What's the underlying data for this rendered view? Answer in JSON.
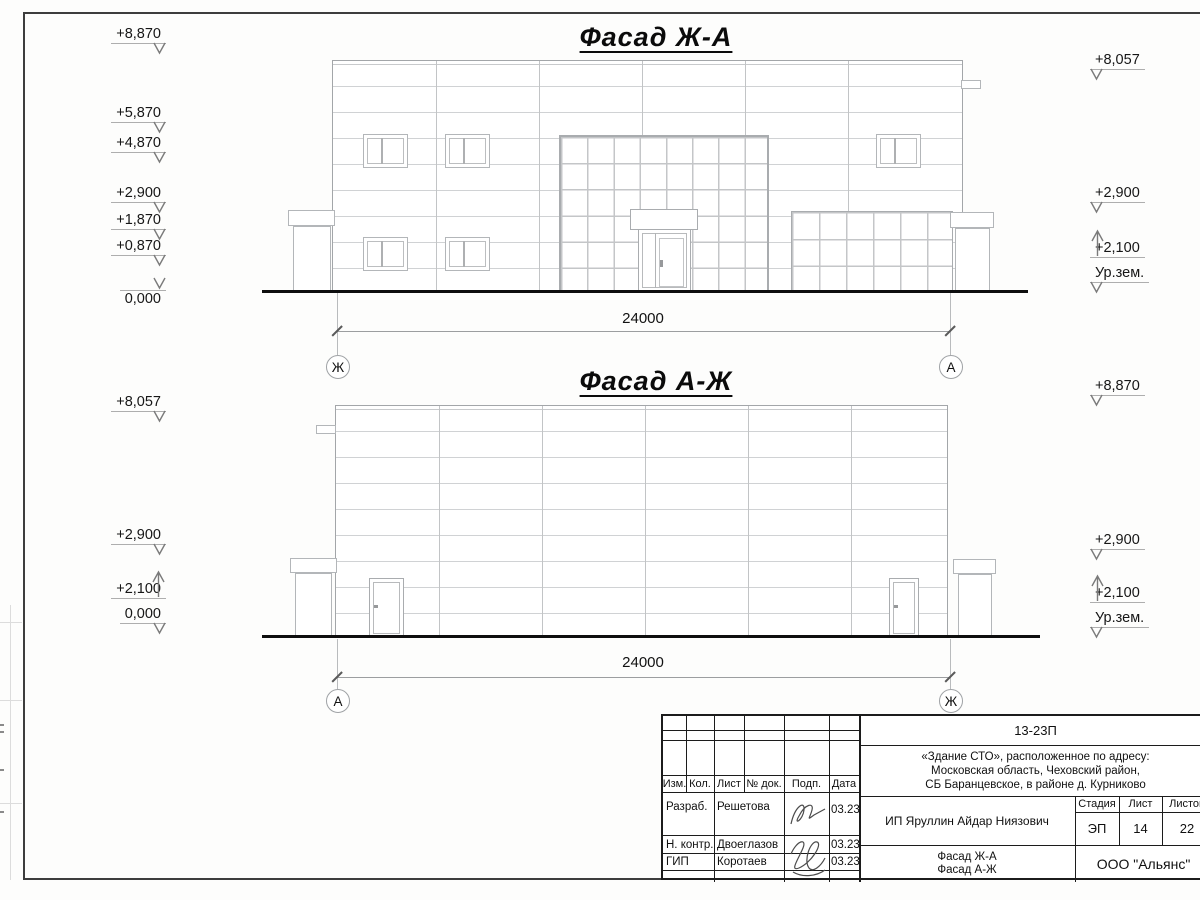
{
  "facade1": {
    "title": "Фасад Ж-А",
    "dimension": "24000",
    "axis_left": "Ж",
    "axis_right": "А",
    "levels_left": [
      "+8,870",
      "+5,870",
      "+4,870",
      "+2,900",
      "+1,870",
      "+0,870",
      "0,000"
    ],
    "levels_right": [
      "+8,057",
      "+2,900",
      "+2,100",
      "Ур.зем."
    ]
  },
  "facade2": {
    "title": "Фасад А-Ж",
    "dimension": "24000",
    "axis_left": "А",
    "axis_right": "Ж",
    "levels_left": [
      "+8,057",
      "+2,900",
      "+2,100",
      "0,000"
    ],
    "levels_right": [
      "+8,870",
      "+2,900",
      "+2,100",
      "Ур.зем."
    ]
  },
  "title_block": {
    "doc_number": "13-23П",
    "address_line1": "«Здание СТО», расположенное по адресу:",
    "address_line2": "Московская область, Чеховский район,",
    "address_line3": "СБ Баранцевское, в районе д. Курниково",
    "client": "ИП Яруллин Айдар Ниязович",
    "stage_label": "Стадия",
    "sheet_label": "Лист",
    "sheets_label": "Листов",
    "stage": "ЭП",
    "sheet_no": "14",
    "sheets_total": "22",
    "content_line1": "Фасад Ж-А",
    "content_line2": "Фасад А-Ж",
    "company": "ООО \"Альянс\"",
    "header_cols": [
      "Изм.",
      "Кол.",
      "Лист",
      "№ док.",
      "Подп.",
      "Дата"
    ],
    "rows": [
      {
        "role": "Разраб.",
        "name": "Решетова",
        "date": "03.23"
      },
      {
        "role": "Н. контр.",
        "name": "Двоеглазов",
        "date": "03.23"
      },
      {
        "role": "ГИП",
        "name": "Коротаев",
        "date": "03.23"
      }
    ]
  }
}
